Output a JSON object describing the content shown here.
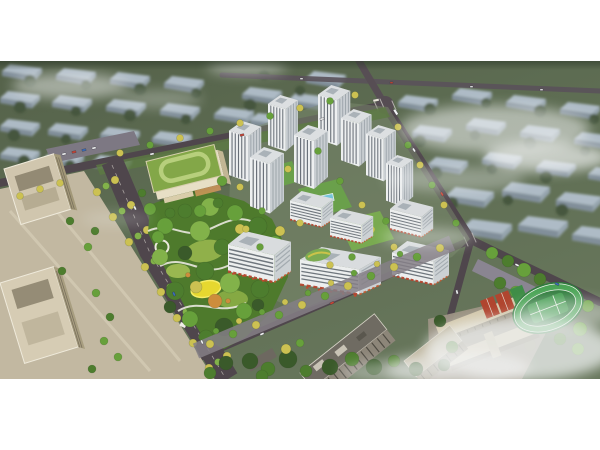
{
  "meta": {
    "description": "Aerial architectural rendering of a residential masterplan: white high-rise towers and mid-rise commercial slabs around a central landscaped park, kindergarten with green roof, tree-lined boulevard, office towers at left, school campus with running track at lower right, hazy city blocks and fog in the background. No visible text in the image.",
    "image_type": "architectural-aerial-rendering"
  },
  "canvas": {
    "width": 600,
    "height": 450,
    "background": "#ffffff",
    "photo_area": {
      "x": 0,
      "y": 61,
      "width": 600,
      "height": 318
    }
  },
  "palette": {
    "background_green": "#5d6c52",
    "background_green_dark": "#46523f",
    "background_roof_blue": "#b5c2d0",
    "background_wall_blue": "#8492a0",
    "road_asphalt": "#4f464c",
    "road_light": "#5a525a",
    "intersection": "#564d53",
    "plaza_beige": "#c2b8a1",
    "park_green": "#4e7a2c",
    "dev_ground": "#7c8a6d",
    "tree_dark": "#3a5a2a",
    "tree_green": "#4d7d2e",
    "tree_vivid": "#67a03b",
    "tree_light": "#82b24a",
    "tree_yellow": "#ccc152",
    "tree_amber": "#cd8d3c",
    "tower_facade": "#edeff0",
    "tower_side": "#c9ced2",
    "tower_window": "#59616a",
    "shopfront_red": "#b5452f",
    "kindergarten_roof": "#83a748",
    "kindergarten_ring": "#b7cf7c",
    "kindergarten_wall": "#e7dfc6",
    "pool_blue": "#76c4da",
    "playground_yellow": "#e6d830",
    "field_green": "#2f7c3c",
    "court_red": "#b0452f",
    "fog_white": "#f2f4f4",
    "office_roof": "#d0c6ae",
    "school_roof": "#d2c7ab",
    "parking_gray": "#7d7883"
  },
  "scene": {
    "regions": [
      {
        "name": "background-city-blocks",
        "label": "hazy rows of mid-rise blocks with blue-gray roofs"
      },
      {
        "name": "road-network",
        "label": "dark asphalt roads with NE intersection and buses"
      },
      {
        "name": "office-plaza",
        "label": "beige office towers and paved plaza, west side"
      },
      {
        "name": "boulevard",
        "label": "tree-lined boulevard with yellow autumn trees"
      },
      {
        "name": "kindergarten",
        "label": "cream kindergarten with green roof and oval track"
      },
      {
        "name": "central-park",
        "label": "dense park, white paths, yellow playground"
      },
      {
        "name": "residential-towers",
        "label": "white high-rise towers of the development"
      },
      {
        "name": "commercial-podium",
        "label": "mid-rise slabs with red shopfronts and roof gardens"
      },
      {
        "name": "school-campus",
        "label": "school slabs, red courts, green running track"
      },
      {
        "name": "existing-buildings",
        "label": "darker foreground buildings outside the site"
      },
      {
        "name": "fog-layer",
        "label": "white fog and cloud wisps"
      }
    ]
  }
}
